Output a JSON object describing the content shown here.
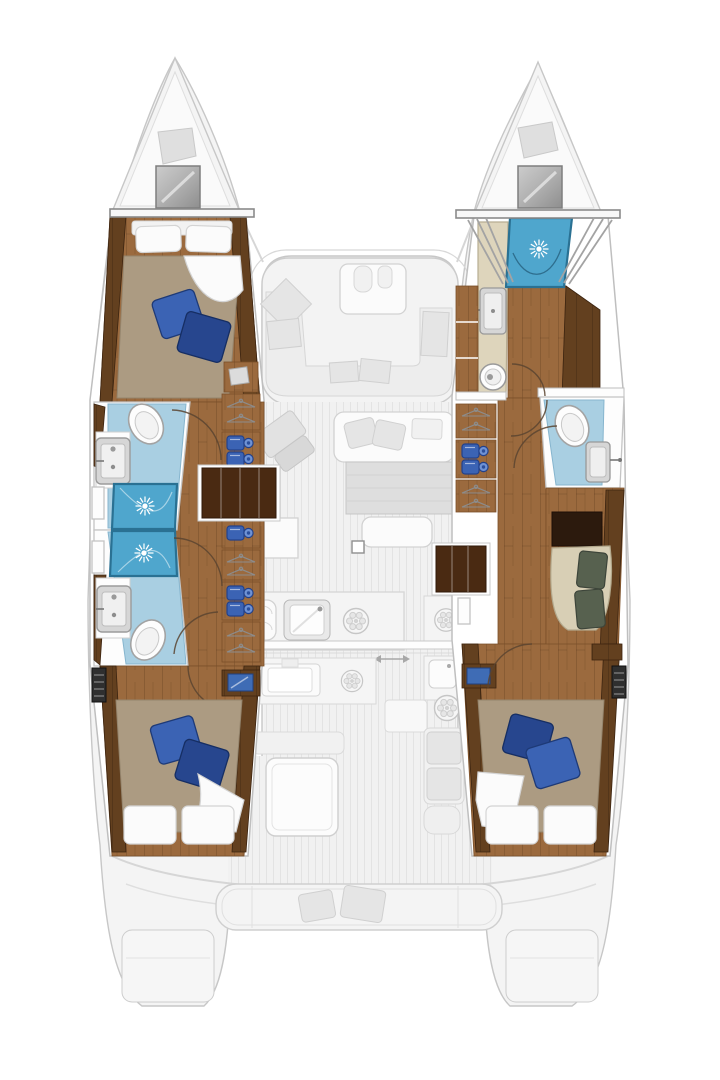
{
  "diagram": {
    "label": "Catamaran yacht deck and interior floor plan, top-down view",
    "type": "boat-floor-plan",
    "cabins": 4,
    "bathrooms": 4,
    "bow_shower": true
  },
  "colors": {
    "wood": "#9b6a3e",
    "wood_dark": "#63401f",
    "wood_steps": "#4a2a12",
    "bath": "#a9cfe2",
    "shower": "#4fa6cd",
    "shower_line": "#2a7193",
    "tan": "#ac9b82",
    "pillow": "#3b63b4",
    "pillow_dark": "#27468e",
    "linen": "#fbfbfb",
    "beige": "#ded5bc",
    "settee": "#d8cfb5",
    "cushion": "#57614f",
    "screen": "#3f6cb5",
    "ghost": "#f4f4f4",
    "ghost_line": "#c7c7c7"
  },
  "port_hull": {
    "forward_cabin": {
      "name": "port forward cabin",
      "features": [
        "island double bed",
        "2 white pillows",
        "2 blue throw pillows",
        "folded sheet"
      ]
    },
    "forward_bathroom": {
      "name": "port forward bathroom",
      "fixtures": [
        "toilet",
        "washbasin",
        "shower with ceiling light"
      ]
    },
    "aft_bathroom": {
      "name": "port aft bathroom",
      "fixtures": [
        "shower with ceiling light",
        "washbasin",
        "toilet"
      ]
    },
    "companionway": {
      "name": "port companionway",
      "features": [
        "steps",
        "hanging lockers",
        "shelf lockers with folded clothes"
      ]
    },
    "aft_cabin": {
      "name": "port aft cabin",
      "features": [
        "double bed",
        "2 white pillows",
        "2 blue throw pillows",
        "tv locker",
        "vent grille"
      ]
    }
  },
  "starboard_hull": {
    "bow_shower": {
      "name": "starboard bow shower",
      "fixtures": [
        "shower with ceiling light",
        "guard rails"
      ]
    },
    "forward_bathroom": {
      "name": "starboard forward bathroom",
      "fixtures": [
        "vanity counter",
        "washbasin",
        "round toilet"
      ]
    },
    "mid_bathroom": {
      "name": "starboard mid bathroom",
      "fixtures": [
        "toilet",
        "washbasin"
      ]
    },
    "dressing_area": {
      "name": "starboard dressing area",
      "features": [
        "dark desk nook",
        "upholstered settee",
        "2 green cushions"
      ]
    },
    "companionway": {
      "name": "starboard companionway",
      "features": [
        "steps",
        "hanging lockers",
        "shelf lockers with folded clothes"
      ]
    },
    "aft_cabin": {
      "name": "starboard aft cabin",
      "features": [
        "double bed",
        "2 white pillows",
        "2 blue throw pillows",
        "tv locker",
        "vent grille"
      ]
    }
  },
  "bridge_deck": {
    "foredeck": {
      "features": [
        "port bow deck hatch",
        "starboard bow deck hatch",
        "anchor lockers"
      ]
    },
    "forward_cockpit": {
      "features": [
        "u-shaped lounge",
        "table with cup holders",
        "gray cushions"
      ]
    },
    "saloon": {
      "features": [
        "sofa with pillows",
        "dining table",
        "bench",
        "angled chart seat",
        "chart table",
        "mast post"
      ]
    },
    "galley": {
      "features": [
        "oven",
        "double sink with faucet",
        "burner",
        "island unit with sink and burner",
        "starboard counter with burner",
        "fridge module",
        "sliding door with arrow"
      ]
    },
    "aft_cockpit": {
      "features": [
        "cockpit table",
        "bench seat",
        "starboard side seats",
        "stern bench with 2 cushions"
      ]
    },
    "stern": {
      "features": [
        "transom curves",
        "port swim platform",
        "starboard swim platform"
      ]
    }
  }
}
